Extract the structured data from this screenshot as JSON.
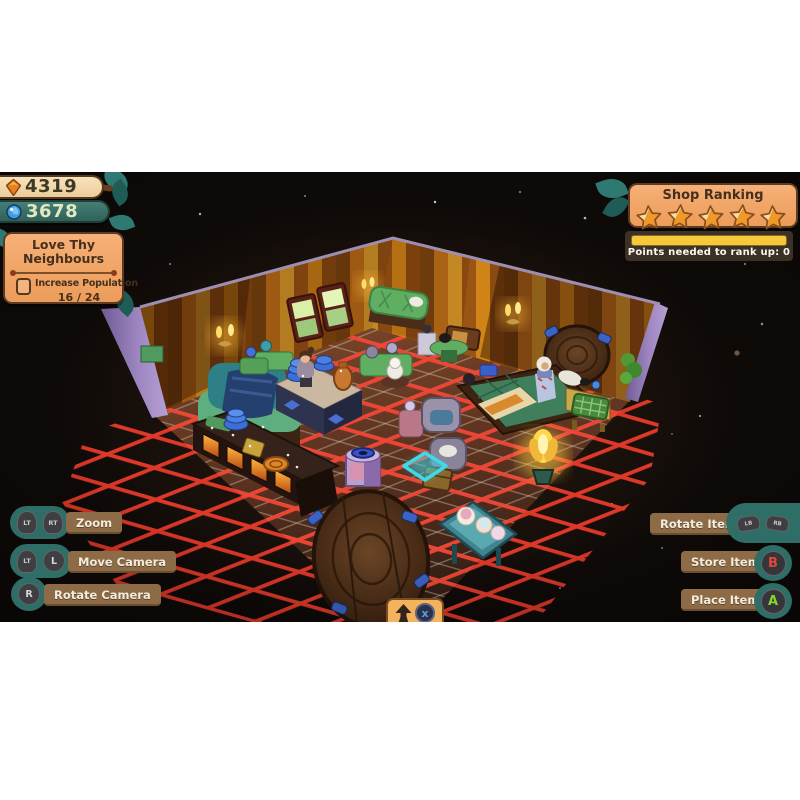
{
  "hud": {
    "currency": [
      {
        "icon": "orange-gem",
        "value": "4319"
      },
      {
        "icon": "blue-orb",
        "value": "3678"
      }
    ],
    "quest": {
      "title_line1": "Love Thy",
      "title_line2": "Neighbours",
      "objective": "Increase Population",
      "objective_checked": false,
      "progress": "16 / 24"
    },
    "shop_ranking": {
      "title": "Shop Ranking",
      "stars_filled": 5,
      "stars_total": 5,
      "progress_percent": 100,
      "points_label": "Points needed to rank up: 0"
    },
    "controls_left": [
      {
        "buttons": [
          "LT",
          "RT"
        ],
        "label": "Zoom"
      },
      {
        "buttons": [
          "LT",
          "L"
        ],
        "label": "Move Camera"
      },
      {
        "buttons": [
          "R"
        ],
        "label": "Rotate Camera"
      }
    ],
    "controls_right": [
      {
        "label": "Rotate Item",
        "buttons": [
          "LB",
          "RB"
        ]
      },
      {
        "label": "Store Item",
        "buttons": [
          "B"
        ]
      },
      {
        "label": "Place Item",
        "buttons": [
          "A"
        ]
      }
    ],
    "bottom_hint": {
      "icon": "up-arrow",
      "button": "x"
    }
  },
  "colors": {
    "letterbox": "#ffffff",
    "sky": "#0e0a08",
    "panel_orange": "#f2a765",
    "panel_border": "#5c3b22",
    "label_brown": "#8d6b46",
    "hint_teal": "#2e6e66",
    "button_dark": "#3f3f41",
    "button_b_red": "#e04838",
    "button_a_green": "#86d62a",
    "button_x_blue": "#4fa0e8",
    "progress_yellow": "#f6c83c",
    "currency_gem_orange": "#e8821f",
    "currency_orb_blue": "#3f9de6",
    "edit_grid_red": "#ef3c2c",
    "highlight_cyan": "#3fd9e8",
    "star_gold": "#f0992b",
    "star_cream": "#f8dca4",
    "wall_stripe_gold": "#e2a12c",
    "wall_trim_purple": "#9d86c0",
    "floor_lattice": "#decdb6"
  }
}
